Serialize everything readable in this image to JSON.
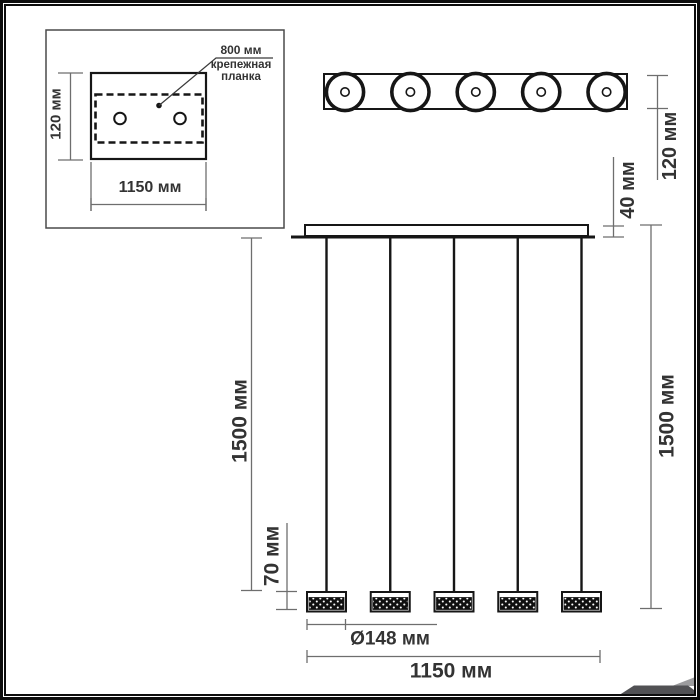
{
  "inset": {
    "hole_spacing_label": "800 мм",
    "mount_bar_label_lines": [
      "крепежная",
      "планка"
    ],
    "depth_label": "120 мм",
    "width_label": "1150 мм"
  },
  "top_view": {
    "lamp_count": 5,
    "depth_label": "120 мм",
    "canopy_thickness_label": "40 мм"
  },
  "front_view": {
    "lamp_count": 5,
    "suspension_left_label": "1500 мм",
    "suspension_right_label": "1500 мм",
    "shade_height_label": "70 мм",
    "shade_diameter_label": "Ø148 мм",
    "overall_width_label": "1150 мм"
  },
  "colors": {
    "line": "#161616",
    "dimension": "#6e6e6e",
    "text": "#333333",
    "background": "#ffffff",
    "fold_dark": "#515154",
    "fold_light": "#9c9c9e"
  }
}
